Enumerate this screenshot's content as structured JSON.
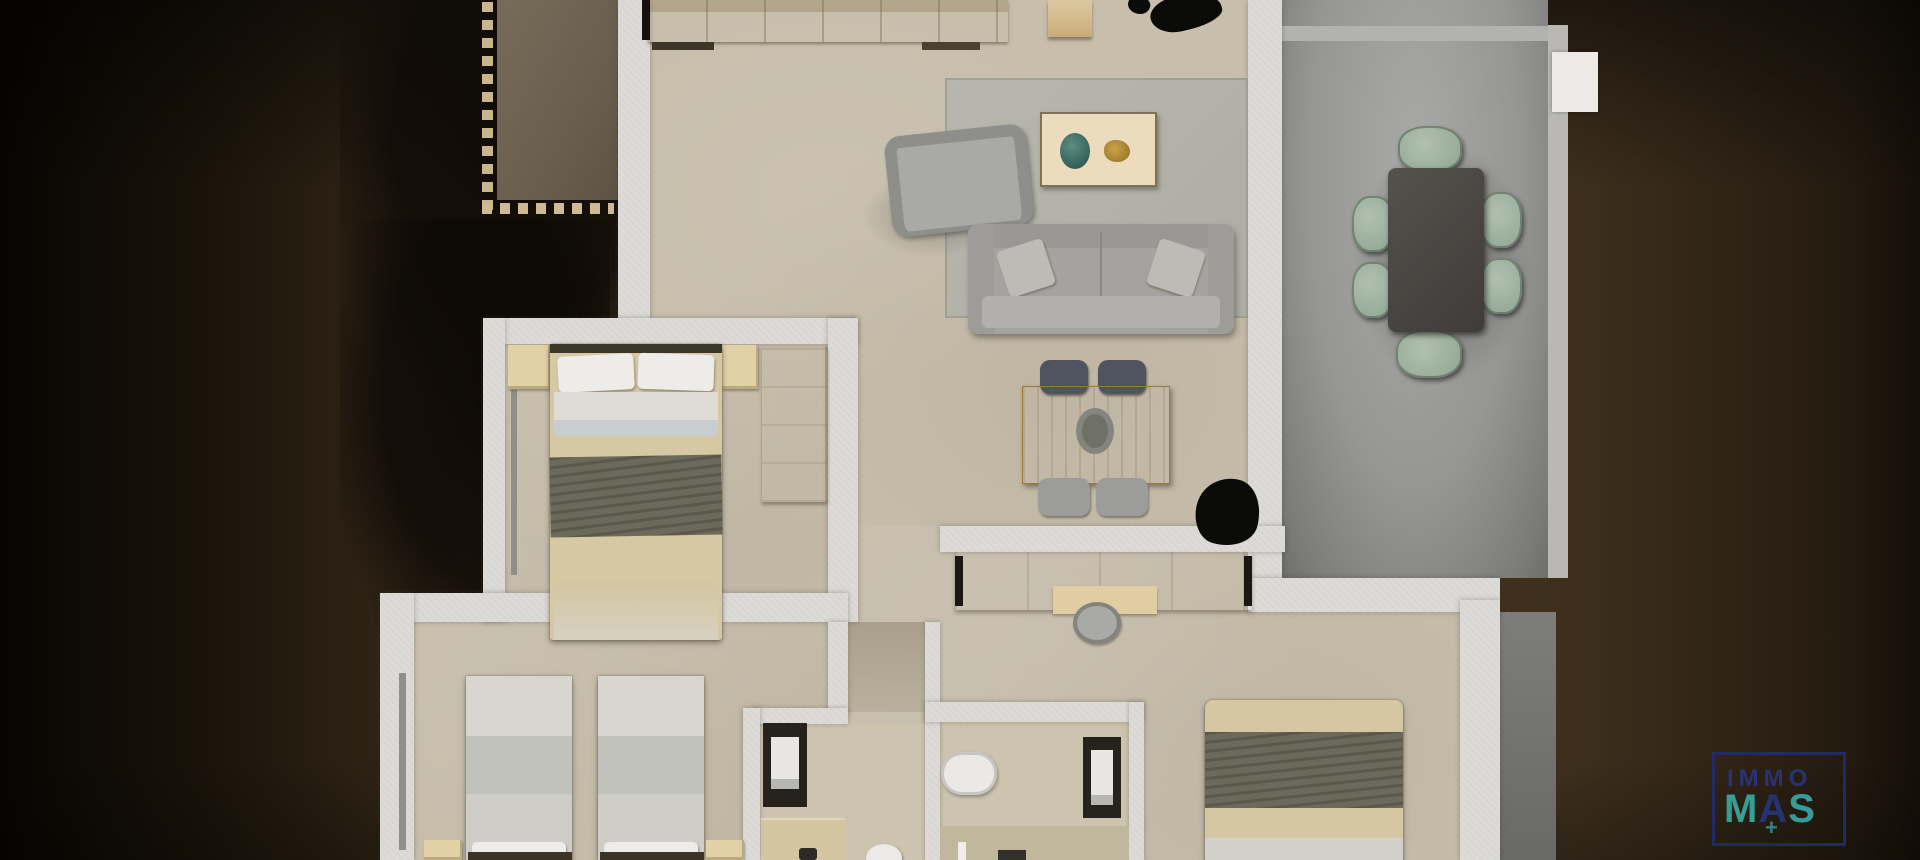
{
  "scene": {
    "kind": "top-down 3D apartment floor plan render",
    "width_px": 1920,
    "height_px": 860
  },
  "watermark": {
    "line1": "IMMO",
    "m": "M",
    "a": "A",
    "s": "S",
    "plus": "+",
    "navy": "#28347e",
    "teal": "#38a8a3"
  },
  "palette": {
    "background_brown_dark": "#191209",
    "background_brown": "#463723",
    "floor_beige": "#c7beac",
    "wall_white": "#dcdbd7",
    "terrace_gray": "#969694",
    "wood_light": "#d3ba8c",
    "wood_oak_desk": "#d8b264",
    "sofa_gray": "#a5a39f",
    "rug_gray": "#b3b3a9",
    "olive_throw": "#6b695a",
    "chair_sage": "#9fb4a4",
    "dining_table_dark": "#4b4745",
    "shower_frame_dark": "#26231f",
    "balcony_floor_taupe": "#6f6454"
  },
  "rooms": [
    {
      "name": "living-room",
      "furniture": [
        "kitchen-counter",
        "area-rug",
        "coffee-table",
        "decor-vase",
        "decor-gold",
        "armchair",
        "sofa",
        "oak-desk-table",
        "four-chairs",
        "black-plant",
        "black-plant-top"
      ]
    },
    {
      "name": "terrace-dining",
      "furniture": [
        "dining-table",
        "six-sage-chairs",
        "open-door-panel"
      ]
    },
    {
      "name": "bedroom-double-left",
      "furniture": [
        "double-bed",
        "two-nightstands",
        "wardrobe"
      ]
    },
    {
      "name": "bedroom-twin-bottom",
      "furniture": [
        "single-bed",
        "single-bed",
        "two-nightstands"
      ]
    },
    {
      "name": "bedroom-double-right",
      "furniture": [
        "double-bed",
        "wardrobe-row",
        "desk",
        "desk-chair"
      ]
    },
    {
      "name": "bathroom-1",
      "furniture": [
        "shower",
        "vanity",
        "toilet"
      ]
    },
    {
      "name": "bathroom-2",
      "furniture": [
        "bathtub",
        "shower",
        "vanity-counter"
      ]
    },
    {
      "name": "balcony",
      "furniture": [
        "baluster-railing"
      ]
    }
  ]
}
